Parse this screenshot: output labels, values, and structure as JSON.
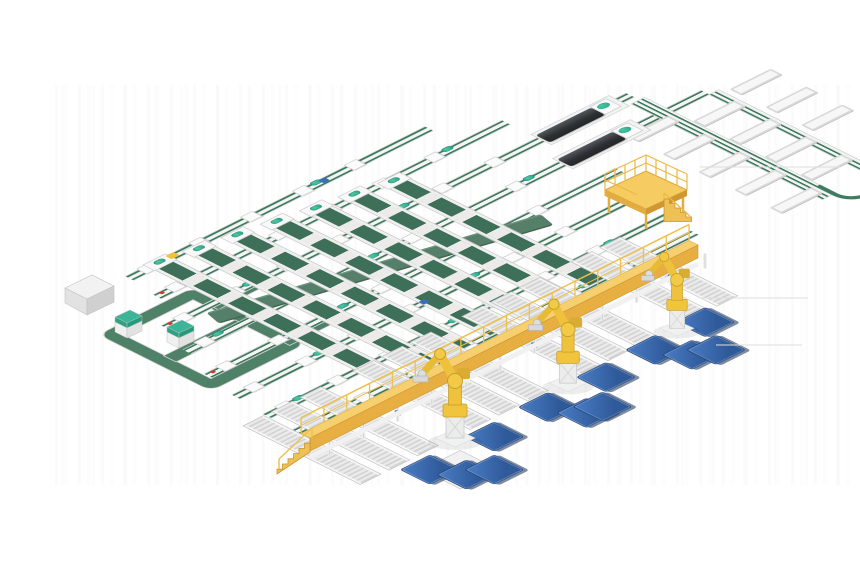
{
  "scene": {
    "description": "Isometric 3D render of an automated parcel sorting line: grid of green cross-belt sorter conveyors, left recirculation loop, top-right chute-tray outfeed spine, two dark print-and-apply machines, a yellow maintenance platform, a long yellow elevated walkway with stairs, three yellow palletizing robots and twelve blue pallets",
    "background_color": "#ffffff",
    "palette": {
      "belt_green": "#3f7c5f",
      "bank_green": "#3e6f58",
      "loop_green": "#4f8068",
      "wide_belt_green": "#567f6a",
      "frame_white": "#f3f3f3",
      "frame_edge": "#c9c9c9",
      "teal_accent": "#3bb597",
      "walkway_yellow": "#f5cb62",
      "walkway_yellow_dark": "#e2ac40",
      "robot_yellow": "#f1c43e",
      "pallet_blue": "#3a6db8",
      "machine_dark": "#2e3134",
      "cabinet_gray": "#e2e2e2"
    },
    "inventory": {
      "trunk_conveyors": 8,
      "incline_conveyor_banks": 7,
      "outfeed_roller_lanes": 11,
      "chute_trays": 12,
      "palletizing_robots": 3,
      "pallets": 12,
      "print_apply_machines": 2,
      "teal_top_cabinets": 2,
      "control_cabinets": 1,
      "maintenance_platforms": 1,
      "elevated_walkways": 1
    }
  },
  "layout": {
    "iso": {
      "origin_x": 430,
      "origin_y": 290,
      "matrix": [
        0.894,
        -0.447,
        0.894,
        0.447
      ]
    },
    "trunks": [
      {
        "v": -181,
        "u0": -155,
        "u1": 180
      },
      {
        "v": -145,
        "u0": -160,
        "u1": 230
      },
      {
        "v": -106,
        "u0": -190,
        "u1": 330
      },
      {
        "v": -67,
        "u0": -205,
        "u1": 375
      },
      {
        "v": -28,
        "u0": -220,
        "u1": 240
      },
      {
        "v": 11,
        "u0": -228,
        "u1": 225
      },
      {
        "v": 50,
        "u0": -232,
        "u1": 218
      },
      {
        "v": 84,
        "u0": -236,
        "u1": 212
      }
    ],
    "columns": {
      "v1": 84,
      "items": [
        {
          "u": -120,
          "v0": -176
        },
        {
          "u": -83,
          "v0": -169
        },
        {
          "u": -46,
          "v0": -163
        },
        {
          "u": -9,
          "v0": -156
        },
        {
          "u": 28,
          "v0": -149
        },
        {
          "u": 65,
          "v0": -143
        },
        {
          "u": 102,
          "v0": -136
        }
      ]
    },
    "lanes": {
      "v0": 48,
      "v1": 178,
      "u": [
        -245,
        -213,
        -181,
        -122,
        -90,
        -58,
        0,
        32,
        64,
        122,
        154
      ]
    },
    "spines": [
      {
        "u": 328,
        "v0": -95,
        "v1": 118,
        "w": 14
      },
      {
        "u": 380,
        "v0": -62,
        "v1": 118,
        "w": 10
      }
    ],
    "uturn": {
      "u0": 331,
      "v0": 100,
      "u1": 388,
      "v1": 140
    },
    "trays": [
      {
        "u": 282,
        "v": -62
      },
      {
        "u": 282,
        "v": -22
      },
      {
        "u": 282,
        "v": 18
      },
      {
        "u": 282,
        "v": 58
      },
      {
        "u": 282,
        "v": 98
      },
      {
        "u": 336,
        "v": -42
      },
      {
        "u": 336,
        "v": -2
      },
      {
        "u": 336,
        "v": 38
      },
      {
        "u": 336,
        "v": 78
      },
      {
        "u": 392,
        "v": -57
      },
      {
        "u": 392,
        "v": -17
      },
      {
        "u": 392,
        "v": 23
      }
    ],
    "loop": {
      "u0": -235,
      "v0": -135,
      "u1": -130,
      "v1": -10,
      "inner_v": -75,
      "stub_vs": [
        -110,
        -30
      ],
      "stub_u0": -140,
      "stub_u1": -95
    },
    "wide_belt": {
      "u": -153,
      "v": -90,
      "len": 307,
      "angle": 14.5
    },
    "machines": [
      {
        "u0": 230,
        "v0": -118
      },
      {
        "u0": 215,
        "v0": -79
      }
    ],
    "pallets": [
      [
        -128,
        200
      ],
      [
        -201,
        201
      ],
      [
        -186,
        227
      ],
      [
        -165,
        237
      ],
      [
        -65,
        197
      ],
      [
        -50,
        225
      ],
      [
        -34,
        227
      ],
      [
        1,
        196
      ],
      [
        59,
        193
      ],
      [
        74,
        219
      ],
      [
        93,
        227
      ],
      [
        118,
        190
      ]
    ],
    "pallet_stand": {
      "u": -206,
      "v": 196
    },
    "accents": [
      {
        "u": -110,
        "v": -186,
        "w": 9,
        "h": 7,
        "c": "#f0c23c"
      },
      {
        "u": -155,
        "v": -149,
        "w": 4,
        "h": 4,
        "c": "#cc3b2f"
      },
      {
        "u": -185,
        "v": -110,
        "w": 4,
        "h": 4,
        "c": "#cc3b2f"
      },
      {
        "u": -215,
        "v": -32,
        "w": 4,
        "h": 4,
        "c": "#cc3b2f"
      },
      {
        "u": 60,
        "v": -185,
        "w": 7,
        "h": 6,
        "c": "#3a6db8"
      },
      {
        "u": -20,
        "v": 7,
        "w": 7,
        "h": 6,
        "c": "#3a6db8"
      }
    ],
    "walkway": {
      "ax": 310,
      "ay": 438,
      "bx": 698,
      "by": 245,
      "deck": 13,
      "rail": 16,
      "posts": 17,
      "legs": 11
    },
    "robots": [
      {
        "x": 455,
        "y": 440,
        "s": 1.0
      },
      {
        "x": 568,
        "y": 385,
        "s": 0.94
      },
      {
        "x": 677,
        "y": 330,
        "s": 0.85
      }
    ],
    "floor_lines": [
      [
        700,
        167,
        840
      ],
      [
        700,
        298,
        808
      ],
      [
        716,
        345,
        802
      ]
    ]
  }
}
